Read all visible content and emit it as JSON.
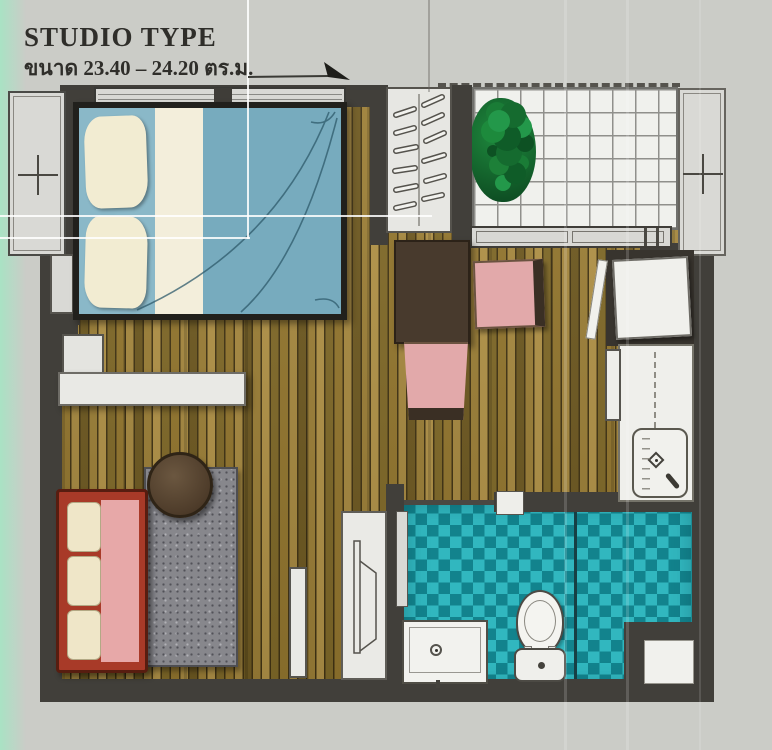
{
  "header": {
    "title": "STUDIO TYPE",
    "subtitle": "ขนาด 23.40 – 24.20 ตร.ม.",
    "area_min": "23.40",
    "area_max": "24.20",
    "area_unit": "ตร.ม."
  },
  "icons": {
    "window_marker": "plus-cross marker on window/AC ledge",
    "annotation_arrow": "leader arrow pointing to bedroom window",
    "hangers": "clothes hangers inside wardrobe",
    "faucet": "sink faucet glyph",
    "tv": "flat tv outline on cabinet"
  },
  "plan": {
    "furniture": [
      "double-bed",
      "wardrobe",
      "balcony-plant",
      "sliding-door",
      "dining-table",
      "chair",
      "chair",
      "refrigerator",
      "kitchen-counter",
      "kitchen-sink",
      "desk-shelf",
      "stool",
      "sofa",
      "rug",
      "round-coffee-table",
      "tv-cabinet",
      "toilet",
      "vanity-sink",
      "service-niche"
    ]
  },
  "colors": {
    "background": "#cbccc7",
    "mint_stripe": "#a9e2c4",
    "wall": "#413f3a",
    "wood_light": "#b29348",
    "wood_dark": "#6f5a22",
    "bed_blue": "#7fb0c1",
    "pillow_cream": "#f2ecd2",
    "blanket_stripe": "#f3eedb",
    "chair_pink": "#e2a9aa",
    "sofa_red": "#a83a28",
    "sofa_seat_pink": "#e7a8a8",
    "rug_gray": "#87878c",
    "dining_table_brown": "#483a2d",
    "coffee_table_brown": "#5a4733",
    "tile_teal_light": "#31b7bf",
    "tile_teal_dark": "#12838d",
    "plant_green": "#1d8038",
    "fixture_white": "#f0f0ec"
  }
}
